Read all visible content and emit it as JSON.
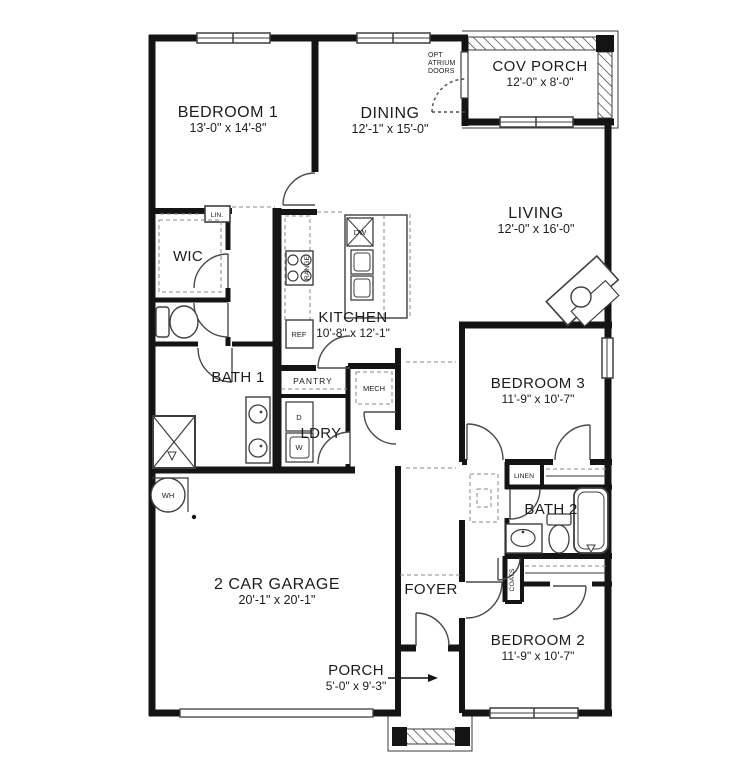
{
  "plan": {
    "rooms": {
      "bedroom1": {
        "name": "BEDROOM 1",
        "dims": "13'-0\" x 14'-8\""
      },
      "dining": {
        "name": "DINING",
        "dims": "12'-1\" x 15'-0\""
      },
      "cov_porch": {
        "name": "COV PORCH",
        "dims": "12'-0\" x 8'-0\""
      },
      "living": {
        "name": "LIVING",
        "dims": "12'-0\" x 16'-0\""
      },
      "kitchen": {
        "name": "KITCHEN",
        "dims": "10'-8\" x 12'-1\""
      },
      "bedroom3": {
        "name": "BEDROOM 3",
        "dims": "11'-9\" x 10'-7\""
      },
      "bedroom2": {
        "name": "BEDROOM 2",
        "dims": "11'-9\" x 10'-7\""
      },
      "garage": {
        "name": "2 CAR GARAGE",
        "dims": "20'-1\" x 20'-1\""
      },
      "porch": {
        "name": "PORCH",
        "dims": "5'-0\" x 9'-3\""
      },
      "foyer": {
        "name": "FOYER"
      },
      "bath1": {
        "name": "BATH 1"
      },
      "bath2": {
        "name": "BATH 2"
      },
      "wic": {
        "name": "WIC"
      },
      "ldry": {
        "name": "LDRY"
      }
    },
    "closets": {
      "lin": "LIN.",
      "linen": "LINEN",
      "coats": "COATS",
      "pantry": "PANTRY",
      "mech": "MECH"
    },
    "appliances": {
      "range": "RANGE",
      "dishwasher": "DW",
      "refrigerator": "REF",
      "dryer": "D",
      "washer": "W",
      "water_heater": "WH"
    },
    "annotations": {
      "opt_atrium_doors_line1": "OPT",
      "opt_atrium_doors_line2": "ATRIUM",
      "opt_atrium_doors_line3": "DOORS"
    }
  }
}
